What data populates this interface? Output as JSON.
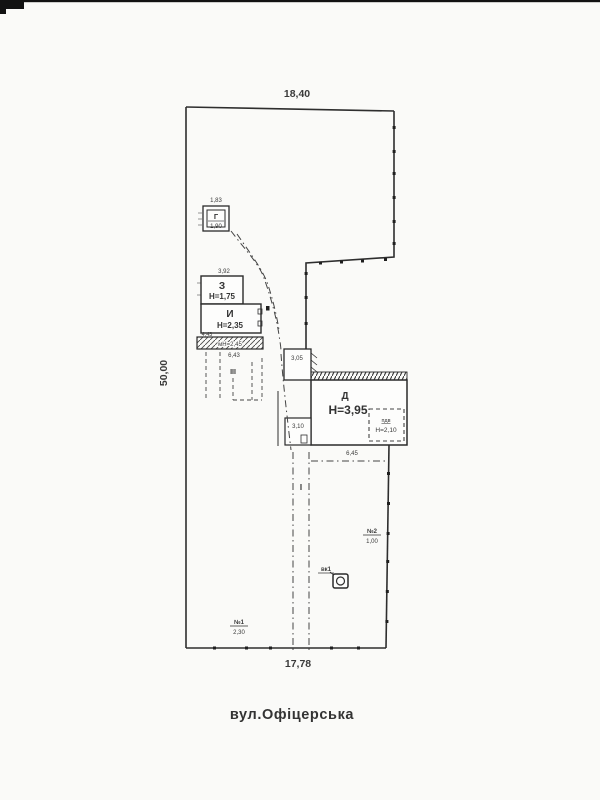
{
  "labels": {
    "dim_top": "18,40",
    "dim_left": "50,00",
    "dim_bottom": "17,78",
    "street": "вул.Офіцерська"
  },
  "buildings": {
    "main": {
      "letter": "Д",
      "height": "Н=3,95",
      "basement_label": "пдв",
      "basement_height": "Н=2,10",
      "dim_ext": "3,05",
      "dim_annex": "3,10",
      "dim_bottom": "6,45"
    },
    "z": {
      "letter": "З",
      "height": "Н=1,75",
      "dim_top": "3,92"
    },
    "i": {
      "letter": "И",
      "height": "Н=2,35",
      "dim_left": "4,43"
    },
    "veranda": {
      "label": "мН=2,45",
      "dim_bottom": "6,43"
    },
    "shed": {
      "letter": "Г",
      "height": "1,90",
      "dim_top": "1,83"
    }
  },
  "markers": {
    "gate1": {
      "label": "№1",
      "value": "2,30"
    },
    "gate2": {
      "label": "№2",
      "value": "1,00"
    },
    "well": {
      "label": "вк1"
    },
    "path": {
      "label": "I"
    },
    "zone": {
      "label": "III"
    }
  }
}
